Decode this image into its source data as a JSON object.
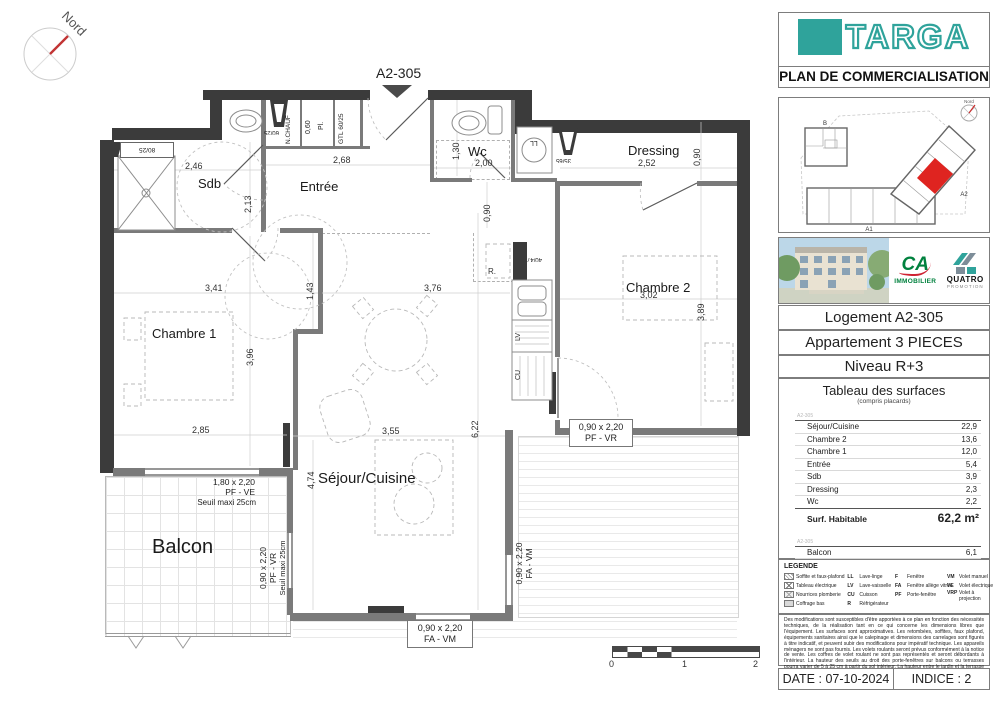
{
  "north": {
    "label": "Nord"
  },
  "plan": {
    "unit_marker": "A2-305",
    "rooms": {
      "sdb": "Sdb",
      "entree": "Entrée",
      "wc": "Wc",
      "dressing": "Dressing",
      "chambre1": "Chambre 1",
      "chambre2": "Chambre 2",
      "sejour": "Séjour/Cuisine",
      "balcon": "Balcon"
    },
    "dims": {
      "sdb_w": "2,46",
      "sdb_h": "2,13",
      "entree_w": "2,68",
      "entree_h": "1,43",
      "wc_w": "2,00",
      "wc_h": "1,30",
      "dressing_w": "2,52",
      "dressing_h": "0,90",
      "hall_h": "0,90",
      "ch1_w": "3,41",
      "ch1_h": "3,96",
      "ch1_w2": "2,85",
      "ch2_w": "3,02",
      "ch2_h": "3,89",
      "sejour_w": "3,76",
      "sejour_w2": "3,55",
      "sejour_h": "6,22",
      "sejour_h2": "4,74"
    },
    "annotations": {
      "gtl": "GTL 60/25",
      "nchauf": "N.CHAUF",
      "pl": "Pl.",
      "pl_dim": "0,60",
      "soffite1": "80/25",
      "soffite2": "60/25",
      "soffite3": "35/65",
      "soffite4": "40/47",
      "ll": "LL",
      "lv": "LV",
      "cu": "CU",
      "r": "R."
    },
    "windows": {
      "w1_dim": "1,80 x 2,20",
      "w1_type": "PF - VE",
      "seuil": "Seuil maxi 25cm",
      "w2_dim": "0,90 x 2,20",
      "w2_type": "PF - VR",
      "w3_dim": "0,90 x 2,20",
      "w3_type": "FA - VM",
      "w4_dim": "0,90 x 2,20",
      "w4_type": "FA - VM",
      "w5_dim": "0,90 x 2,20",
      "w5_type": "PF - VR"
    },
    "scale": {
      "t0": "0",
      "t1": "1",
      "t2": "2"
    }
  },
  "sidebar": {
    "brand": "TARGA",
    "subtitle": "PLAN DE COMMERCIALISATION",
    "keyplan": {
      "north": "Nord",
      "building_b": "B",
      "building_a1": "A1",
      "building_a2": "A2"
    },
    "logos": {
      "ca_name": "CA",
      "ca_sub": "IMMOBILIER",
      "quatro_name": "QUATRO",
      "quatro_sub": "PROMOTION"
    },
    "info": {
      "logement": "Logement A2-305",
      "type": "Appartement 3 PIECES",
      "niveau": "Niveau R+3"
    },
    "surfaces": {
      "title": "Tableau des surfaces",
      "subtitle": "(compris placards)",
      "unit_ref": "A2-305",
      "rows": [
        {
          "label": "Séjour/Cuisine",
          "value": "22,9"
        },
        {
          "label": "Chambre 2",
          "value": "13,6"
        },
        {
          "label": "Chambre 1",
          "value": "12,0"
        },
        {
          "label": "Entrée",
          "value": "5,4"
        },
        {
          "label": "Sdb",
          "value": "3,9"
        },
        {
          "label": "Dressing",
          "value": "2,3"
        },
        {
          "label": "Wc",
          "value": "2,2"
        }
      ],
      "total_label": "Surf. Habitable",
      "total_value": "62,2 m²",
      "annex_rows": [
        {
          "label": "Balcon",
          "value": "6,1"
        }
      ],
      "annex_total_label": "Surf. Totale annexes",
      "annex_total_value": "6,1 m²"
    },
    "legend": {
      "title": "LEGENDE",
      "col1": [
        {
          "label": "Soffite et faux-plafond"
        },
        {
          "label": "Tableau électrique"
        },
        {
          "label": "Nourrices plomberie"
        },
        {
          "label": "Coffrage bas"
        }
      ],
      "col2": [
        {
          "abbr": "LL",
          "label": "Lave-linge"
        },
        {
          "abbr": "LV",
          "label": "Lave-vaisselle"
        },
        {
          "abbr": "CU",
          "label": "Cuisson"
        },
        {
          "abbr": "R",
          "label": "Réfrigérateur"
        }
      ],
      "col3": [
        {
          "abbr": "F",
          "label": "Fenêtre"
        },
        {
          "abbr": "FA",
          "label": "Fenêtre allège vitrée"
        },
        {
          "abbr": "PF",
          "label": "Porte-fenêtre"
        }
      ],
      "col4": [
        {
          "abbr": "VM",
          "label": "Volet manuel"
        },
        {
          "abbr": "VE",
          "label": "Volet électrique"
        },
        {
          "abbr": "VRP",
          "label": "Volet à projection"
        }
      ]
    },
    "disclaimer": "Des modifications sont susceptibles d'être apportées à ce plan en fonction des nécessités techniques, de la réalisation tant en ce qui concerne les dimensions libres que l'équipement. Les surfaces sont approximatives. Les retombées, soffites, faux plafond, équipements sanitaires ainsi que le calepinage et dimensions des carrelages sont figurés à titre indicatif, et peuvent subir des modifications pour impératif technique. Les appareils ménagers ne sont pas fournis. Les volets roulants seront prévus conformément à la notice de vente. Les coffres de volet roulant ne sont pas représentés et seront débordants à l'intérieur. La hauteur des seuils au droit des porte-fenêtres sur balcons ou terrasses pourra varier de 5 à 25 cm à partir du sol intérieur. La hauteur entre le jardin et la terrasse pourra varier entre 0 et 60 cm. Les jardins ne seront pas nécessairement plats et pourront comporter des talus et des pentes.",
    "disclaimer2": "La végétation et les arbres ne sont pas représentés sur ce plan.",
    "date": "DATE : 07-10-2024",
    "indice": "INDICE : 2"
  },
  "colors": {
    "brand_teal": "#2fa39b",
    "unit_red": "#df2420",
    "ca_green": "#00813e"
  }
}
